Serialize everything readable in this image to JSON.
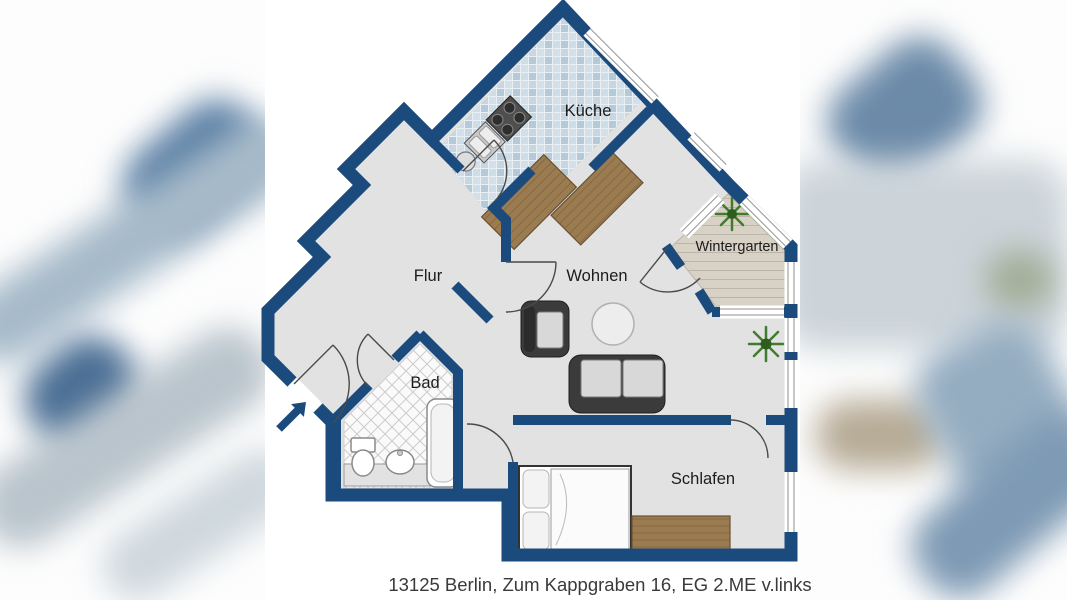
{
  "plan": {
    "rooms": {
      "kueche": {
        "label": "Küche"
      },
      "flur": {
        "label": "Flur"
      },
      "wohnen": {
        "label": "Wohnen"
      },
      "wintergarten": {
        "label": "Wintergarten"
      },
      "bad": {
        "label": "Bad"
      },
      "schlafen": {
        "label": "Schlafen"
      }
    },
    "icons": {
      "entrance_arrow": "entrance-arrow"
    }
  },
  "caption": {
    "text": "13125 Berlin, Zum Kappgraben 16, EG 2.ME v.links"
  },
  "colors": {
    "wall": "#1b4a7c",
    "floor": "#e2e2e2",
    "caption_text": "#3a3a3a",
    "wood": "#9b7b50",
    "wood_line": "#886844",
    "plant": "#3f7d2c",
    "tile_a": "#c6d6e2",
    "tile_b": "#d3e0e9",
    "tile_c": "#b4cad9",
    "tile_d": "#cfdde7",
    "wintergarten_floor": "#d8d1c5"
  }
}
